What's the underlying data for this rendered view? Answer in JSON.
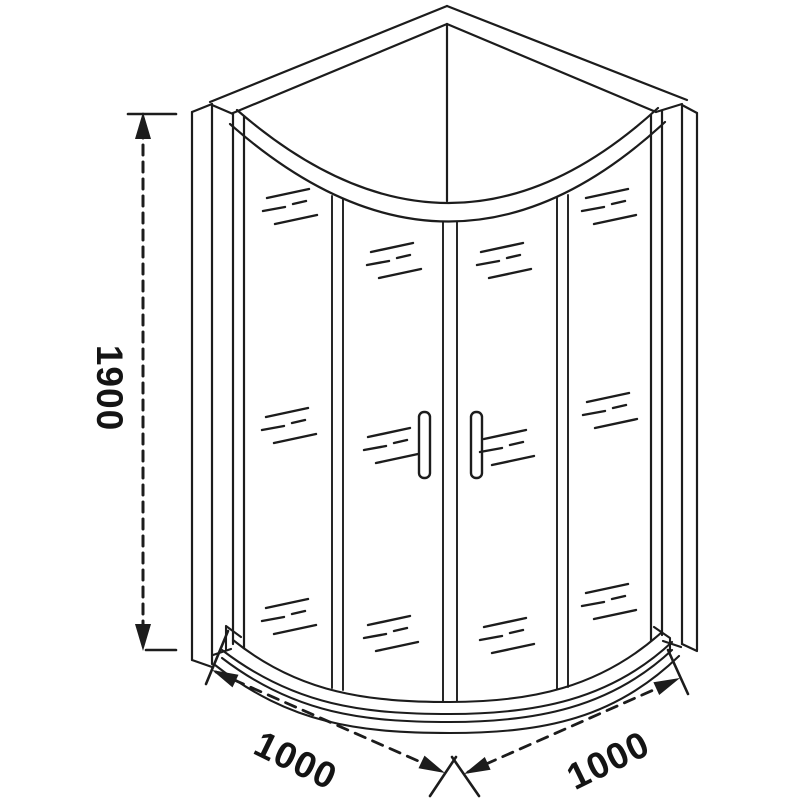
{
  "diagram": {
    "background_color": "#ffffff",
    "line_color": "#1c1c1c",
    "text_color": "#141414",
    "dimensions": {
      "height": {
        "label": "1900",
        "axis": "vertical-left"
      },
      "width_left": {
        "label": "1000",
        "axis": "bottom-left-diagonal"
      },
      "width_right": {
        "label": "1000",
        "axis": "bottom-right-diagonal"
      }
    }
  }
}
